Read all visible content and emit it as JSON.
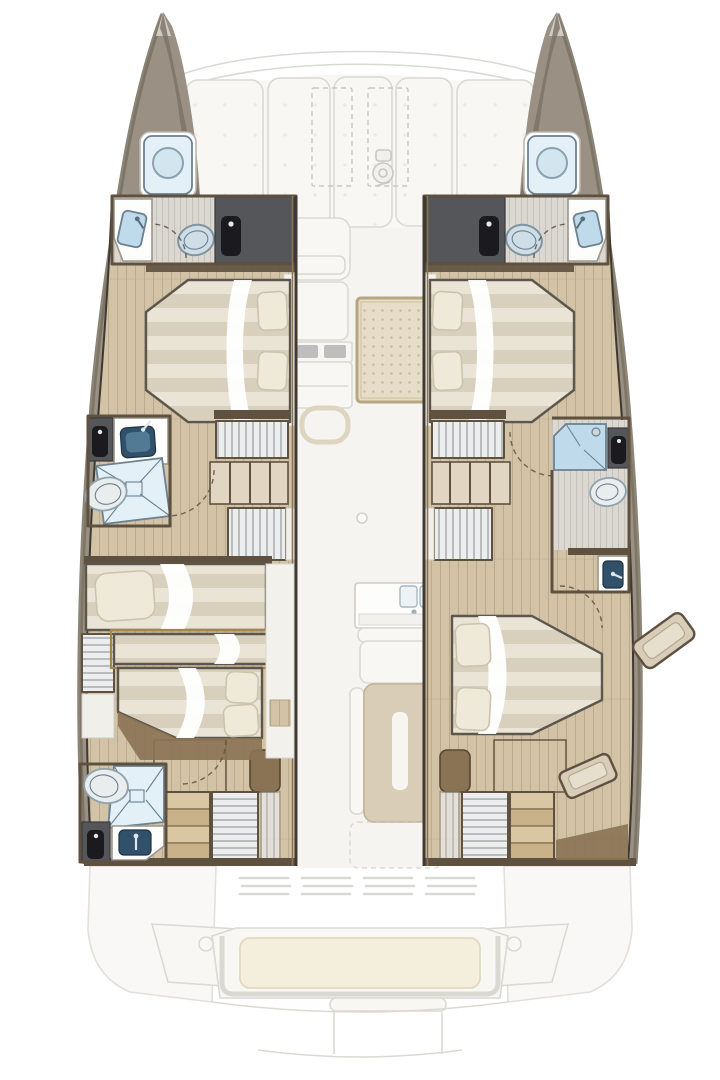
{
  "colors": {
    "background": "#ffffff",
    "ghostFill": "#f8f7f4",
    "ghostLine": "#dbd9d3",
    "ghostDark": "#c9c7c1",
    "hull": "#9a9184",
    "hullShade": "#78705f",
    "hullDark": "#3e3931",
    "trim": "#5f5140",
    "trimGold": "#a5854c",
    "wood": "#d2c3a7",
    "woodLine": "#bcab8d",
    "woodDark": "#8a7354",
    "woodLight": "#e0d6c2",
    "greyFloor": "#dbd8d1",
    "greyLine": "#c6c2ba",
    "cabinet": "#55565a",
    "cabinetDark": "#1b1b1f",
    "bedLight": "#e9e4d6",
    "bedDark": "#d8d0bc",
    "bedOutline": "#5d564c",
    "pillow": "#efe9da",
    "pillowEdge": "#ccc3ad",
    "sheet": "#ffffff",
    "glass": "#bfdaea",
    "glassLight": "#e3f0f7",
    "glassEdge": "#6c8191",
    "sinkNavy": "#31506a",
    "porcelain": "#e9edee",
    "porcelainEdge": "#8fa2ad",
    "slat": "#a6abb0",
    "slatBg": "#eceded",
    "stepLight": "#d9c6a2",
    "stepDark": "#c9b28a",
    "cushion": "#f4eedd",
    "cushionEdge": "#e2d9bf",
    "rug": "#e6dcc8",
    "rugDot": "#c9bda1",
    "rugEdge": "#b7a67f",
    "tableTan": "#d9cdb8"
  },
  "diagram": {
    "type": "yacht-floor-plan",
    "subject": "catamaran-lower-deck-layout",
    "features": {
      "foredeck": [
        "bow-sunpads",
        "deck-hatches",
        "windlass-icon"
      ],
      "port_hull": [
        "bow-head",
        "forepeak-hatch",
        "forward-double-berth",
        "mid-head-with-shower",
        "companionway-stairs",
        "shelf-unit",
        "aft-single-berth",
        "hanging-locker",
        "mid-berth",
        "aft-double-berth",
        "aft-head-with-shower",
        "aft-stairs"
      ],
      "starboard_hull": [
        "bow-head",
        "forepeak-hatch",
        "forward-double-berth",
        "companionway-stairs",
        "shelf-unit",
        "mid-head-with-shower",
        "aft-double-berth",
        "bench-seats",
        "aft-stairs"
      ],
      "main_deck_ghost": [
        "helm-seat",
        "helm-console",
        "grab-handle",
        "cockpit-rug",
        "galley-sink",
        "settee",
        "saloon-table",
        "deck-drain",
        "transom-vents",
        "cockpit-bench",
        "swim-platform"
      ]
    }
  }
}
